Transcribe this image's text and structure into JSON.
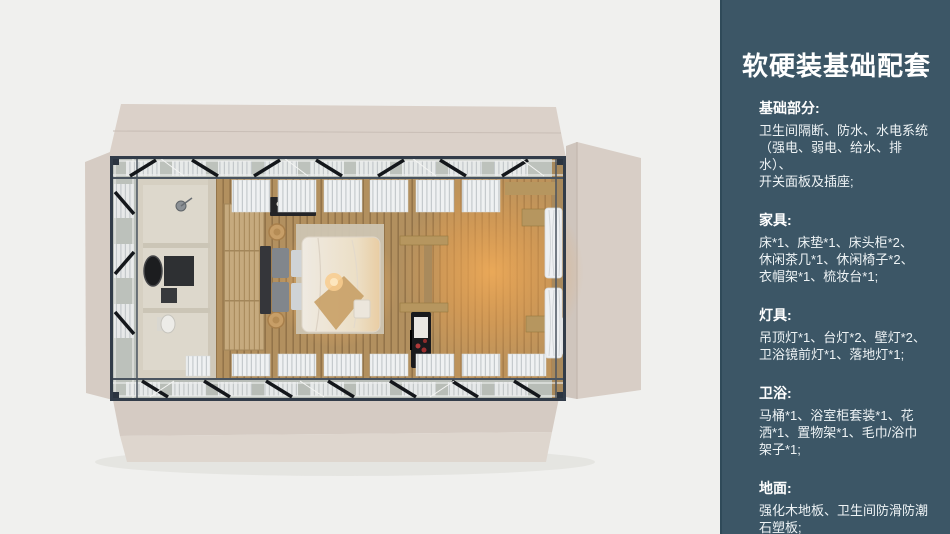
{
  "panel": {
    "title": "软硬装基础配套",
    "background_color": "#3c5666",
    "text_color": "#ffffff",
    "sections": [
      {
        "heading": "基础部分:",
        "body": "卫生间隔断、防水、水电系统\n（强电、弱电、给水、排水）、\n开关面板及插座;"
      },
      {
        "heading": "家具:",
        "body": "床*1、床垫*1、床头柜*2、\n休闲茶几*1、休闲椅子*2、\n衣帽架*1、梳妆台*1;"
      },
      {
        "heading": "灯具:",
        "body": "吊顶灯*1、台灯*2、壁灯*2、\n卫浴镜前灯*1、落地灯*1;"
      },
      {
        "heading": "卫浴:",
        "body": "马桶*1、浴室柜套装*1、花\n洒*1、置物架*1、毛巾/浴巾\n架子*1;"
      },
      {
        "heading": "地面:",
        "body": "强化木地板、卫生间防滑防潮\n石塑板;"
      }
    ]
  },
  "scene": {
    "type": "3d-top-view-render",
    "palette": {
      "page_background": "#f0f0ee",
      "container_panels": "#d8cec6",
      "steel_frame": "#333d49",
      "wood_floor": "#b2905f",
      "warm_light": "#f0a85a",
      "bathroom_floor": "#ddd8cc",
      "bedding": "#efeae2"
    },
    "depicted_items": [
      "bathroom",
      "vanity-basin",
      "toilet",
      "shower",
      "wardrobe",
      "double-bed",
      "pillows",
      "rug",
      "bar-shelf",
      "round-stools",
      "shelf-unit",
      "mini-fridge",
      "curtains",
      "window-blinds",
      "steel-truss-frame",
      "wood-plank-floor"
    ]
  }
}
